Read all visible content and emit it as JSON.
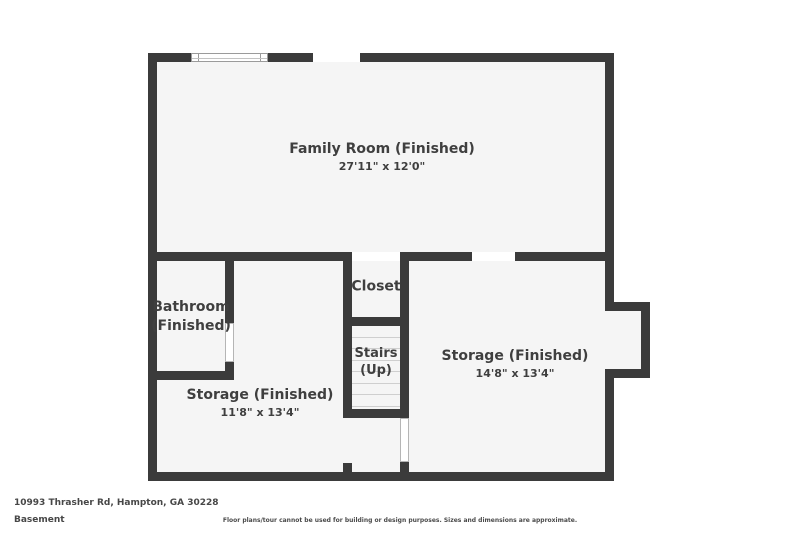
{
  "plan": {
    "level_title": "Basement",
    "rooms": {
      "family_room": {
        "name": "Family Room (Finished)",
        "dims": "27'11\" x 12'0\""
      },
      "bathroom": {
        "line1": "Bathroom",
        "line2": "(Finished)"
      },
      "closet": {
        "name": "Closet"
      },
      "stairs": {
        "line1": "Stairs",
        "line2": "(Up)"
      },
      "storage_left": {
        "name": "Storage (Finished)",
        "dims": "11'8\" x 13'4\""
      },
      "storage_right": {
        "name": "Storage (Finished)",
        "dims": "14'8\" x 13'4\""
      }
    },
    "colors": {
      "wall": "#3b3b3b",
      "floor": "#f5f5f5",
      "label_text": "#3f3f3f"
    }
  },
  "footer": {
    "address": "10993 Thrasher Rd, Hampton, GA 30228",
    "level": "Basement",
    "disclaimer": "Floor plans/tour cannot be used for building or design purposes. Sizes and dimensions are approximate."
  }
}
